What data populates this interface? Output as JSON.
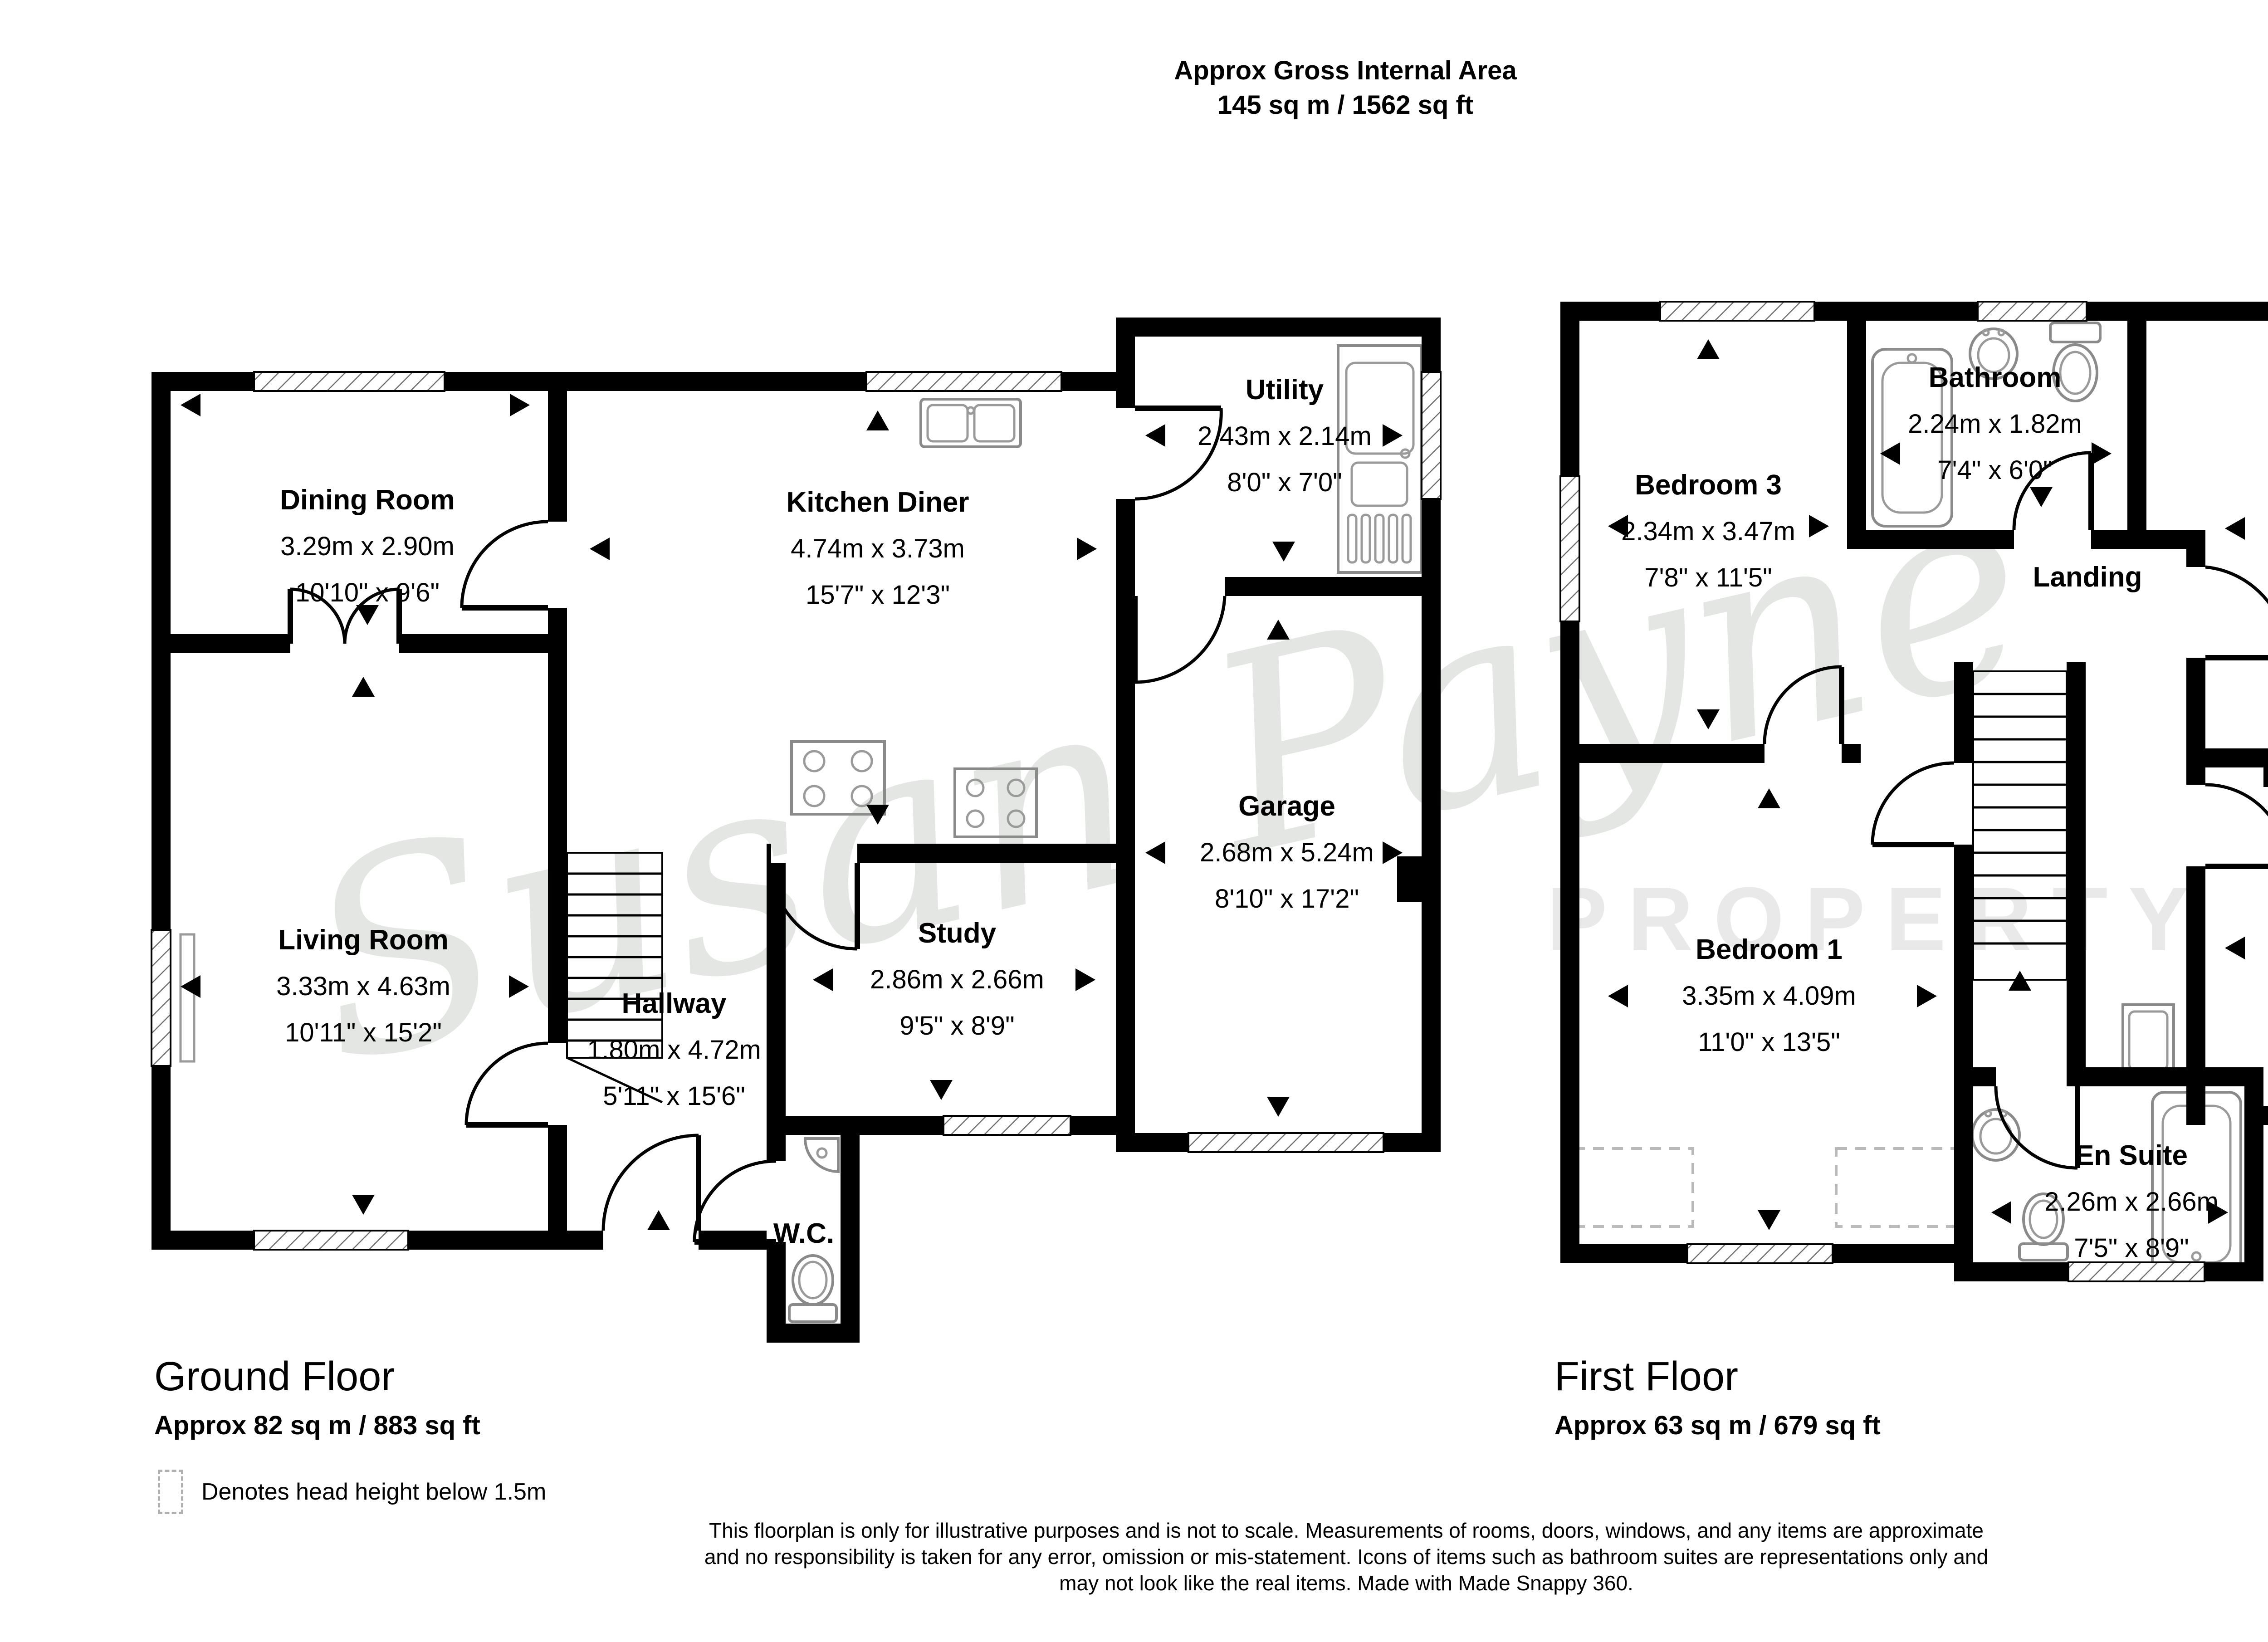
{
  "header": {
    "line1": "Approx Gross Internal Area",
    "line2": "145 sq m / 1562 sq ft"
  },
  "watermark": {
    "script": "Susan Payne",
    "caption": "PROPERTY"
  },
  "ground_floor": {
    "title": "Ground Floor",
    "area": "Approx 82 sq m / 883 sq ft",
    "rooms": [
      {
        "name": "Dining Room",
        "metric": "3.29m x 2.90m",
        "imperial": "10'10\" x 9'6\""
      },
      {
        "name": "Kitchen Diner",
        "metric": "4.74m x 3.73m",
        "imperial": "15'7\" x 12'3\""
      },
      {
        "name": "Utility",
        "metric": "2.43m x 2.14m",
        "imperial": "8'0\" x 7'0\""
      },
      {
        "name": "Living Room",
        "metric": "3.33m x 4.63m",
        "imperial": "10'11\" x 15'2\""
      },
      {
        "name": "Garage",
        "metric": "2.68m x 5.24m",
        "imperial": "8'10\" x 17'2\""
      },
      {
        "name": "Study",
        "metric": "2.86m x 2.66m",
        "imperial": "9'5\" x 8'9\""
      },
      {
        "name": "Hallway",
        "metric": "1.80m x 4.72m",
        "imperial": "5'11\" x 15'6\""
      },
      {
        "name": "W.C.",
        "metric": "",
        "imperial": ""
      }
    ]
  },
  "first_floor": {
    "title": "First Floor",
    "area": "Approx 63 sq m / 679 sq ft",
    "rooms": [
      {
        "name": "Bedroom 3",
        "metric": "2.34m x 3.47m",
        "imperial": "7'8\" x 11'5\""
      },
      {
        "name": "Bathroom",
        "metric": "2.24m x 1.82m",
        "imperial": "7'4\" x 6'0\""
      },
      {
        "name": "Bedroom 2",
        "metric": "3.48m x 3.77m",
        "imperial": "11'5\" x 12'4\""
      },
      {
        "name": "Landing",
        "metric": "",
        "imperial": ""
      },
      {
        "name": "Bedroom 1",
        "metric": "3.35m x 4.09m",
        "imperial": "11'0\" x 13'5\""
      },
      {
        "name": "Bedroom 4",
        "metric": "2.88m x 2.64m",
        "imperial": "9'5\" x 8'8\""
      },
      {
        "name": "En Suite",
        "metric": "2.26m x 2.66m",
        "imperial": "7'5\" x 8'9\""
      }
    ]
  },
  "legend": {
    "text": "Denotes head height below 1.5m"
  },
  "disclaimer": {
    "line1": "This floorplan is only for illustrative purposes and is not to scale. Measurements of rooms, doors, windows, and any items are approximate",
    "line2": "and no responsibility is taken for any error, omission or mis-statement. Icons of items such as bathroom suites are representations only and",
    "line3": "may not look like the real items. Made with Made Snappy 360."
  }
}
